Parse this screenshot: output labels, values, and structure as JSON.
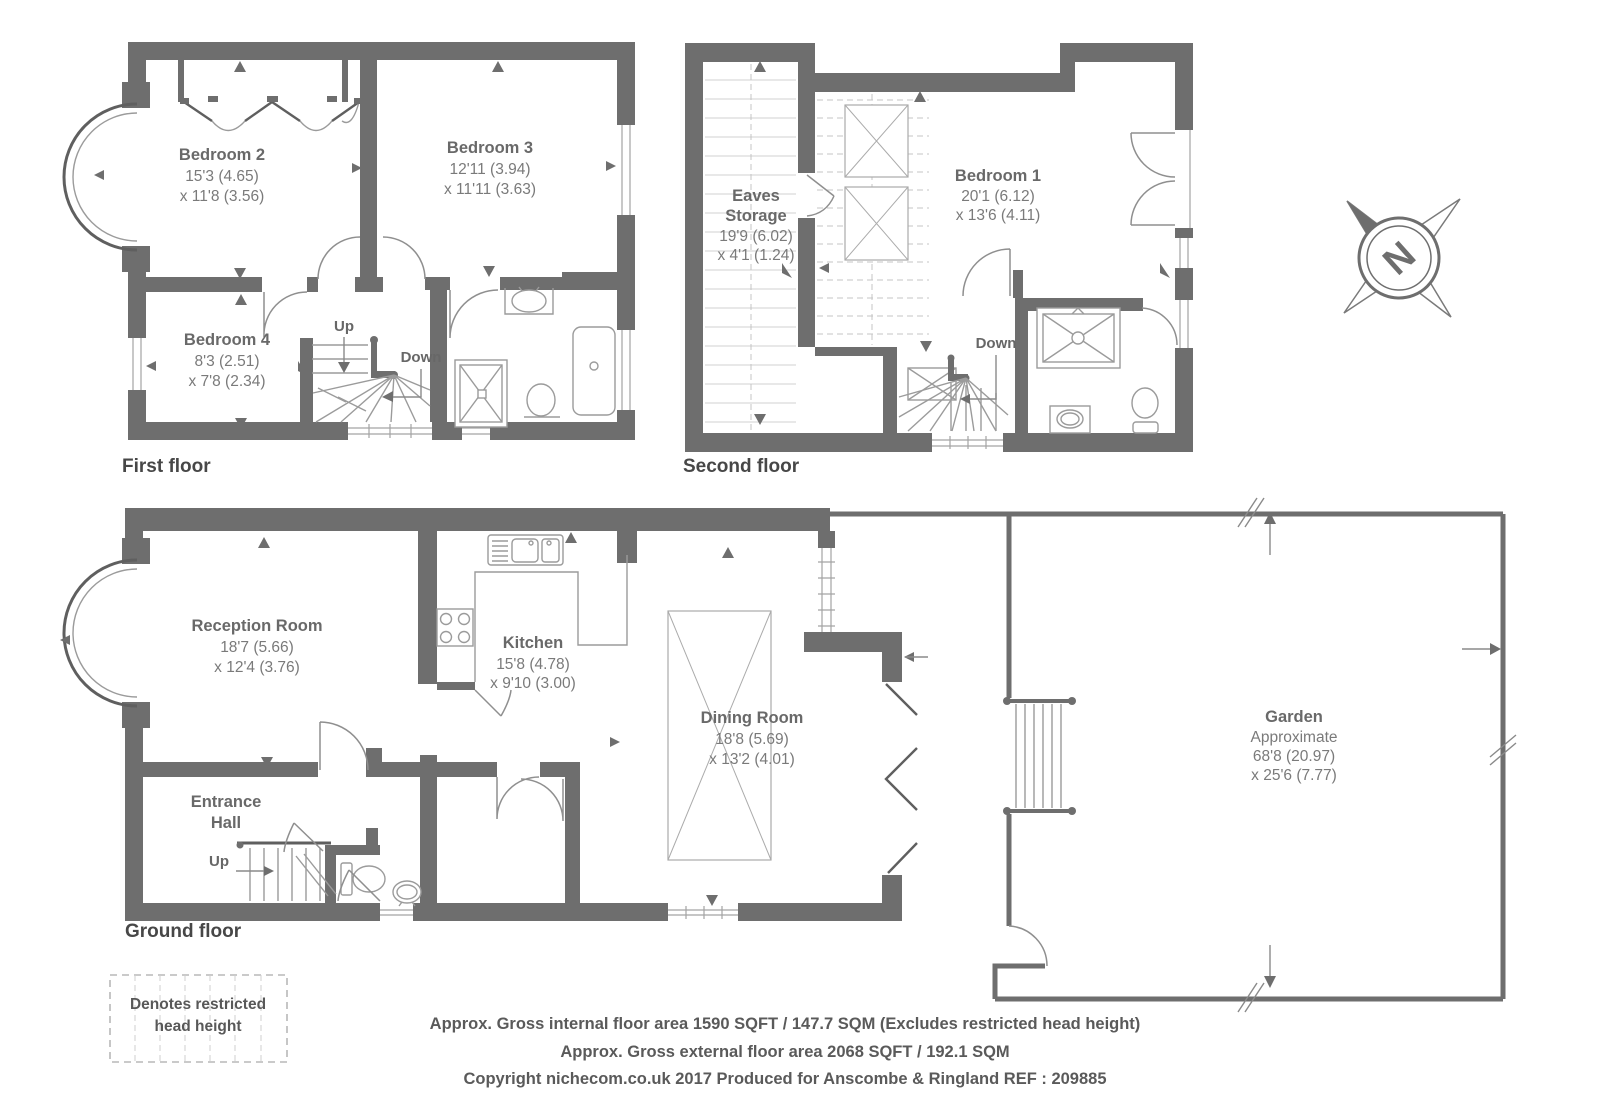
{
  "colors": {
    "wall": "#6e6e6e",
    "fixture": "#9b9b9b",
    "room_text": "#696969",
    "dim_text": "#7a7a7a",
    "footer_text": "#5a5a5a"
  },
  "floors": {
    "first": {
      "label": "First floor",
      "bedroom2": {
        "name": "Bedroom 2",
        "dim1": "15'3 (4.65)",
        "dim2": "x 11'8 (3.56)"
      },
      "bedroom3": {
        "name": "Bedroom 3",
        "dim1": "12'11 (3.94)",
        "dim2": "x 11'11 (3.63)"
      },
      "bedroom4": {
        "name": "Bedroom 4",
        "dim1": "8'3 (2.51)",
        "dim2": "x 7'8 (2.34)"
      },
      "up": "Up",
      "down": "Down"
    },
    "second": {
      "label": "Second floor",
      "eaves": {
        "name1": "Eaves",
        "name2": "Storage",
        "dim1": "19'9 (6.02)",
        "dim2": "x 4'1 (1.24)"
      },
      "bedroom1": {
        "name": "Bedroom 1",
        "dim1": "20'1 (6.12)",
        "dim2": "x 13'6 (4.11)"
      },
      "down": "Down"
    },
    "ground": {
      "label": "Ground floor",
      "reception": {
        "name": "Reception Room",
        "dim1": "18'7 (5.66)",
        "dim2": "x 12'4 (3.76)"
      },
      "kitchen": {
        "name": "Kitchen",
        "dim1": "15'8 (4.78)",
        "dim2": "x 9'10 (3.00)"
      },
      "entrance": {
        "name1": "Entrance",
        "name2": "Hall"
      },
      "dining": {
        "name": "Dining Room",
        "dim1": "18'8 (5.69)",
        "dim2": "x 13'2 (4.01)"
      },
      "garden": {
        "name": "Garden",
        "sub": "Approximate",
        "dim1": "68'8 (20.97)",
        "dim2": "x 25'6 (7.77)"
      },
      "up": "Up"
    }
  },
  "compass": {
    "north": "N"
  },
  "legend": {
    "line1": "Denotes restricted",
    "line2": "head height"
  },
  "footer": {
    "line1": "Approx. Gross internal floor area 1590 SQFT / 147.7 SQM (Excludes restricted head height)",
    "line2": "Approx. Gross external floor area 2068 SQFT / 192.1 SQM",
    "line3": "Copyright nichecom.co.uk 2017 Produced for Anscombe & Ringland REF : 209885"
  }
}
